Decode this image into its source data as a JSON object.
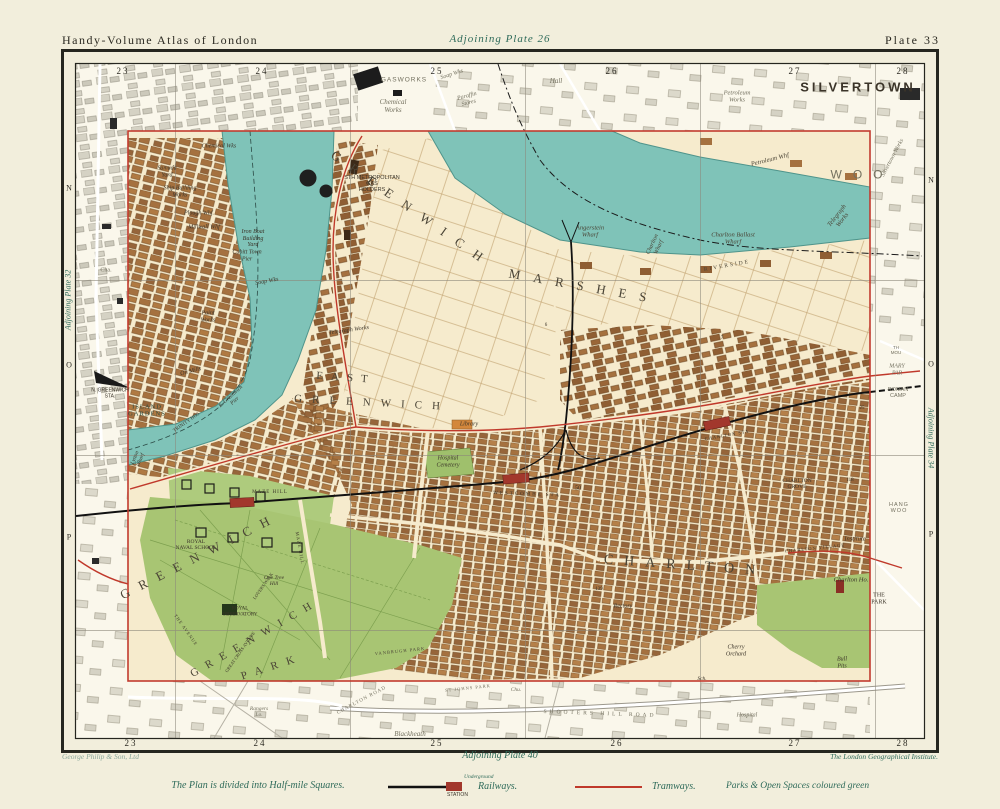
{
  "header": {
    "left": "Handy-Volume Atlas of London",
    "center": "Adjoining Plate 26",
    "right": "Plate 33"
  },
  "grid": {
    "top": [
      "23",
      "24",
      "25",
      "26",
      "27",
      "28"
    ],
    "bottom": [
      "23",
      "24",
      "25",
      "26",
      "27",
      "28"
    ],
    "left": [
      "N",
      "O",
      "P"
    ],
    "right": [
      "N",
      "O",
      "P"
    ],
    "adjoining_left": "Adjoining Plate 32",
    "adjoining_right": "Adjoining Plate 34"
  },
  "labels": {
    "silvertown": "SILVERTOWN",
    "gasworks": "GASWORKS",
    "chemical_works": "Chemical\nWorks",
    "hall": "Hall",
    "soap_w": "Soap Wks",
    "paraffin": "Paraffin\nStores",
    "petroleum_works": "Petroleum\nWorks",
    "silvertown_works": "Silvertown Works",
    "woolwich": "WOO",
    "petroleum_whf": "Petroleum Whf",
    "telegraph_works_r": "Telegraph\nWorks",
    "charlton_ballast": "Charlton Ballast\nWharf",
    "charlton_whf": "Charlton\nWharf",
    "angerstein": "Angerstein\nWharf",
    "riverside": "RIVERSIDE",
    "greenwich_marsh": "GREENWICH",
    "marshes": "MARSHES",
    "gas_holders": "STH METROPOLITAN\nGAS\nHOLDERS",
    "samuda": "Samuda\nYard",
    "shipbuilding": "Ship Building\nWorks",
    "plough": "Plough Whf.",
    "millwall": "Millwall Whf",
    "ironboat": "Iron Boat\nBuilding\nYard",
    "cubitt_pier": "Cubitt Town\nPier",
    "cha": "Cha.",
    "soap_wks2": "Soap Wks",
    "paint_works": "Paint\nWorks",
    "chemical_wks2": "Chemical Wks",
    "telegraph2": "Telegraph Works",
    "oil_mills": "Oil Mills",
    "n_greenwich": "N. GREENWICH\nSTA.",
    "island_gardens": "ISLAND\nGARDENS",
    "e_pier": "E. Greenwich\nPier",
    "trinity": "TRINITY HOS",
    "lytton": "Lytton\nWharf",
    "east": "EAST",
    "east_greenwich": "GREENWICH",
    "library": "Library",
    "cemetery": "Hospital\nCemetery",
    "westcombe_sta": "WESTCOMBE STA",
    "fifty": "50",
    "n6": "6",
    "n7": "7",
    "maze_hill_sta": "MAZE HILL",
    "maze_hill_rd": "MAZE HILL",
    "royal_naval": "ROYAL\nNAVAL SCHOOL",
    "royal_obs": "ROYAL\nOBSERVATORY",
    "one_tree": "One Tree\nHill",
    "greenwich_town": "GREENWICH",
    "greenwich_park_lbl": "GREENWICH",
    "park_lbl": "PARK",
    "the_avenue": "THE AVENUE",
    "great_cross": "GREAT CROSS AVENUE",
    "lovers_walk": "LOVERS WALK",
    "charlton_big": "CHARLTON",
    "charlton_grove": "CHARLTON\nGROVE",
    "institute": "Institute",
    "charlton_village": "CHARLTON VILLAGE",
    "charlton_ho": "Charlton Ho.",
    "the_park": "THE\nPARK",
    "cherry": "Cherry\nOrchard",
    "bull_pits": "Bull\nPits",
    "sch": "Sch.",
    "rectory": "Rectory",
    "n139": "139",
    "charlton_sta_lbl": "CHARLTON STA",
    "roman_camp": "ROMAN\nCAMP",
    "mary_par": "MARY\nPAR",
    "th_mou": "TH\nMOU",
    "hang_woo": "HANG\nWOO",
    "n25": "25",
    "n118": "118",
    "blackheath": "Blackheath",
    "shooters": "SHOOTERS HILL ROAD",
    "st_johns": "ST JOHNS PARK",
    "charlton_road": "CHARLTON ROAD",
    "vanbrugh": "VANBRUGH PARK",
    "rangers": "Rangers\nLo.",
    "hospital": "Hospital",
    "chu": "Chu."
  },
  "footer": {
    "publisher": "George Philip & Son, Ltd",
    "adjoining": "Adjoining Plate 40",
    "institute": "The London Geographical Institute.",
    "note": "The Plan is divided into Half-mile Squares.",
    "legend": {
      "underground": "Underground",
      "station": "STATION",
      "railways": "Railways.",
      "tramways": "Tramways.",
      "parks": "Parks & Open Spaces coloured green"
    }
  },
  "colors": {
    "river": "#7fc3b8",
    "park_green": "#a8c573",
    "building_brown": "#a5713f",
    "plate_border_red": "#c23b2e",
    "station_red": "#a2372c",
    "tram_red": "#c0392b"
  }
}
